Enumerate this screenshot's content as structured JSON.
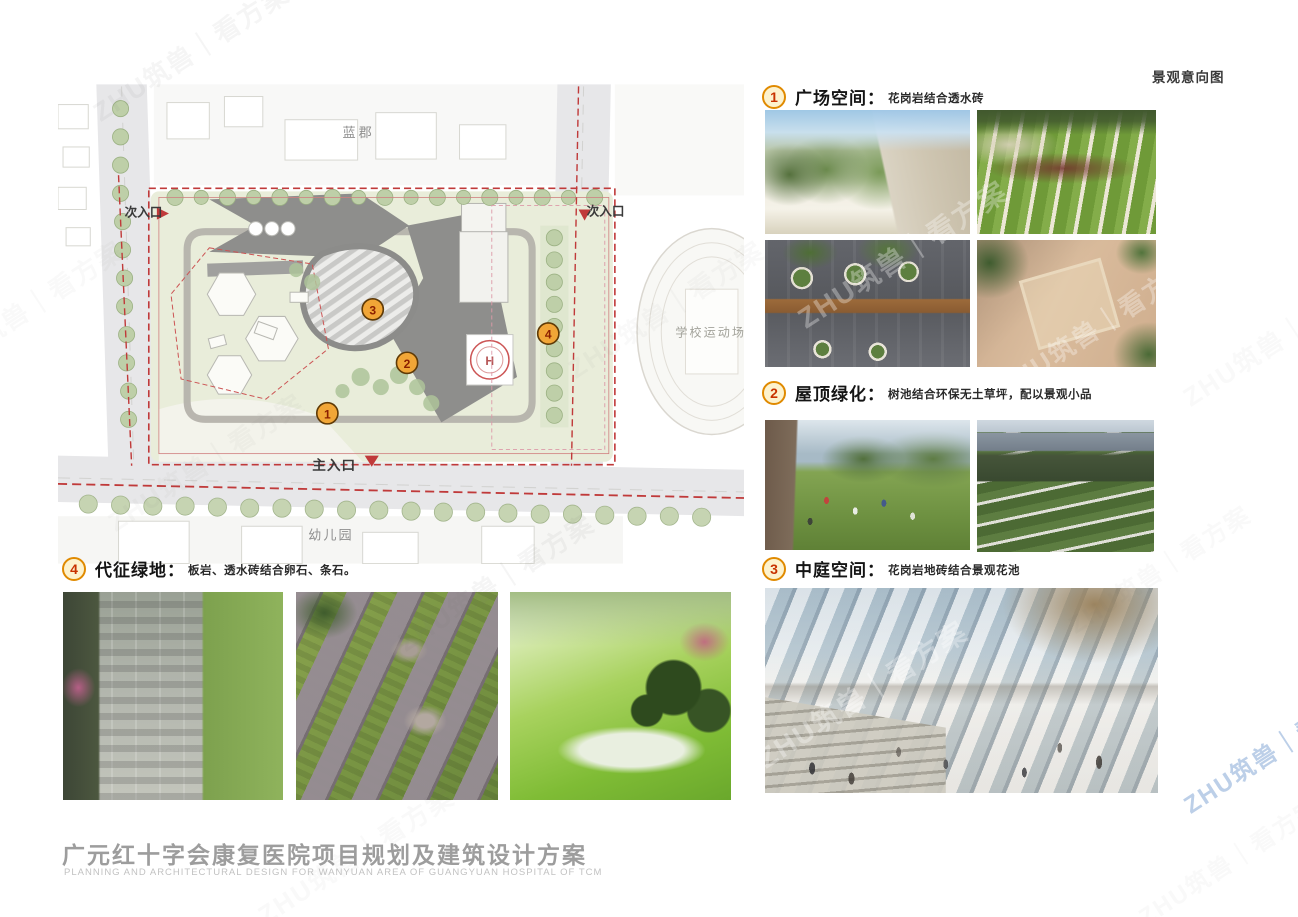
{
  "page": {
    "corner_label": "景观意向图",
    "title_cn": "广元红十字会康复医院项目规划及建筑设计方案",
    "title_en": "PLANNING AND ARCHITECTURAL DESIGN FOR WANYUAN AREA OF GUANGYUAN HOSPITAL OF TCM",
    "watermark_text": "ZHU筑兽｜看方案"
  },
  "colors": {
    "accent_orange": "#e08a00",
    "marker_fill": "#f1a637",
    "marker_number": "#8b1f00",
    "boundary_red": "#c03a3a",
    "title_gray": "#9d9d9d"
  },
  "site_plan": {
    "labels": {
      "residential_north": "蓝郡",
      "secondary_entrance_west": "次入口",
      "secondary_entrance_east": "次入口",
      "school_field": "学校运动场",
      "main_entrance": "主入口",
      "kindergarten": "幼儿园",
      "helipad": "H"
    },
    "markers": [
      "1",
      "2",
      "3",
      "4"
    ]
  },
  "sections": [
    {
      "number": "1",
      "title": "广场空间",
      "separator": "：",
      "desc": "花岗岩结合透水砖"
    },
    {
      "number": "2",
      "title": "屋顶绿化",
      "separator": "：",
      "desc": "树池结合环保无土草坪，配以景观小品"
    },
    {
      "number": "3",
      "title": "中庭空间",
      "separator": "：",
      "desc": "花岗岩地砖结合景观花池"
    },
    {
      "number": "4",
      "title": "代征绿地",
      "separator": "：",
      "desc": "板岩、透水砖结合卵石、条石。"
    }
  ]
}
